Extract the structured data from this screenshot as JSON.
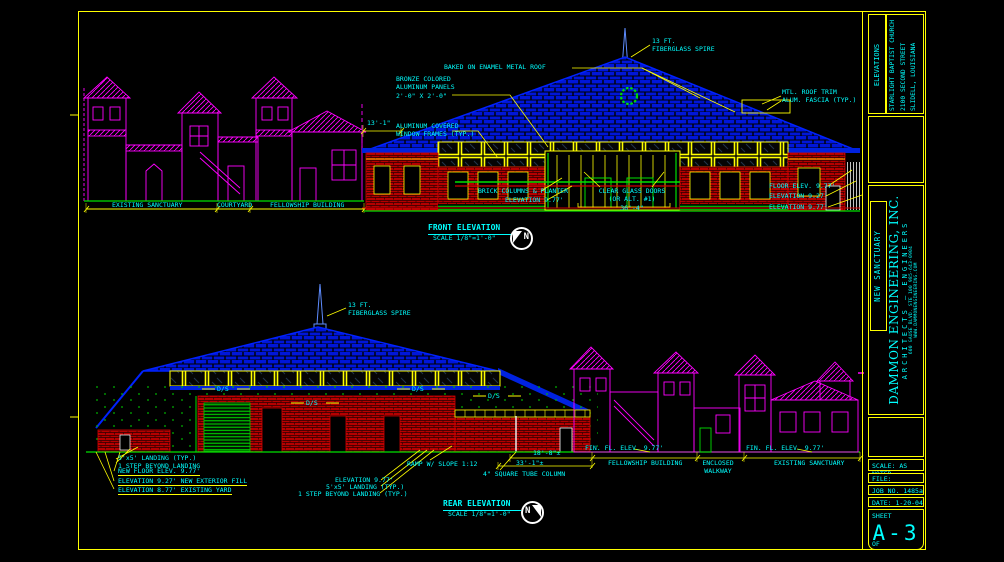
{
  "front": {
    "title": "FRONT ELEVATION",
    "scale": "SCALE 1/8\"=1'-0\"",
    "labels": {
      "spire": "13 FT.\nFIBERGLASS SPIRE",
      "baked_roof": "BAKED ON ENAMEL METAL ROOF",
      "bronze_panels": "BRONZE COLORED\nALUMINUM PANELS\n2'-0\" X 2'-0\"",
      "window_frames": "ALUMINUM COVERED\nWINDOW FRAMES (TYP.)",
      "roof_trim": "MTL. ROOF TRIM\nALUM. FASCIA (TYP.)",
      "brick_columns": "BRICK COLUMNS & PLANTER",
      "elevation_977": "ELEVATION 9.77'",
      "glass_doors": "CLEAR GLASS DOORS\n(OR ALT. #1)\n36'-4\"",
      "floor_elev": "FLOOR ELEV. 9.77'",
      "elevation_927": "ELEVATION 9.27'",
      "elevation_977b": "ELEVATION 9.77'",
      "dim_eave": "13'-1\"",
      "existing_sanctuary": "EXISTING SANCTUARY",
      "courtyard": "COURTYARD",
      "fellowship_building": "FELLOWSHIP BUILDING"
    }
  },
  "rear": {
    "title": "REAR ELEVATION",
    "scale": "SCALE 1/8\"=1'-0\"",
    "labels": {
      "spire": "13 FT.\nFIBERGLASS SPIRE",
      "landing_steps": "5'x5' LANDING (TYP.)\n1 STEP BEYOND LANDING",
      "new_floor": "NEW FLOOR ELEV. 9.77'",
      "exterior_fill": "ELEVATION 9.27' NEW EXTERIOR FILL",
      "existing_yard": "ELEVATION 8.77' EXISTING YARD",
      "elevation_977": "ELEVATION 9.77'",
      "landing": "5'x5' LANDING (TYP.)",
      "step_beyond": "1 STEP BEYOND LANDING (TYP.)",
      "ramp": "RAMP W/ SLOPE 1:12",
      "tube_column": "4\" SQUARE TUBE COLUMN",
      "dim_18_8": "18'-8\"±",
      "dim_33_1": "33'-1\"±",
      "fin_floor_left": "FIN. FL. ELEV. 9.77'",
      "fellowship_building": "FELLOWSHIP BUILDING",
      "fin_floor_right": "FIN. FL. ELEV. 9.77'",
      "enclosed_walkway": "ENCLOSED\nWALKWAY",
      "existing_sanctuary": "EXISTING SANCTUARY",
      "downspout": "D/S"
    }
  },
  "north_letter": "N",
  "title_block": {
    "discipline": "ELEVATIONS",
    "project": "STARLIGHT BAPTIST CHURCH\n2100 SECOND STREET\nSLIDELL, LOUISIANA",
    "project_name": "NEW SANCTUARY",
    "firm_name": "DAMMON ENGINEERING, INC.",
    "firm_type": "ARCHITECTS — ENGINEERS",
    "firm_address": "600 GAUSE BLVD. STE 100  985-643-0904",
    "firm_web": "WWW.DAMMONENGINEERING.COM",
    "scale": "SCALE: AS NOTED",
    "file": "FILE:",
    "job": "JOB NO. 1485a",
    "date": "DATE: 1-20-04",
    "sheet_label": "SHEET",
    "sheet_number": "A-3",
    "of_label": "OF"
  },
  "colors": {
    "line_yellow": "#ffff00",
    "text_cyan": "#00ffff",
    "roof_blue": "#0018e8",
    "brick_red": "#d90000",
    "existing_magenta": "#ff00ff",
    "grade_green": "#00e000"
  }
}
